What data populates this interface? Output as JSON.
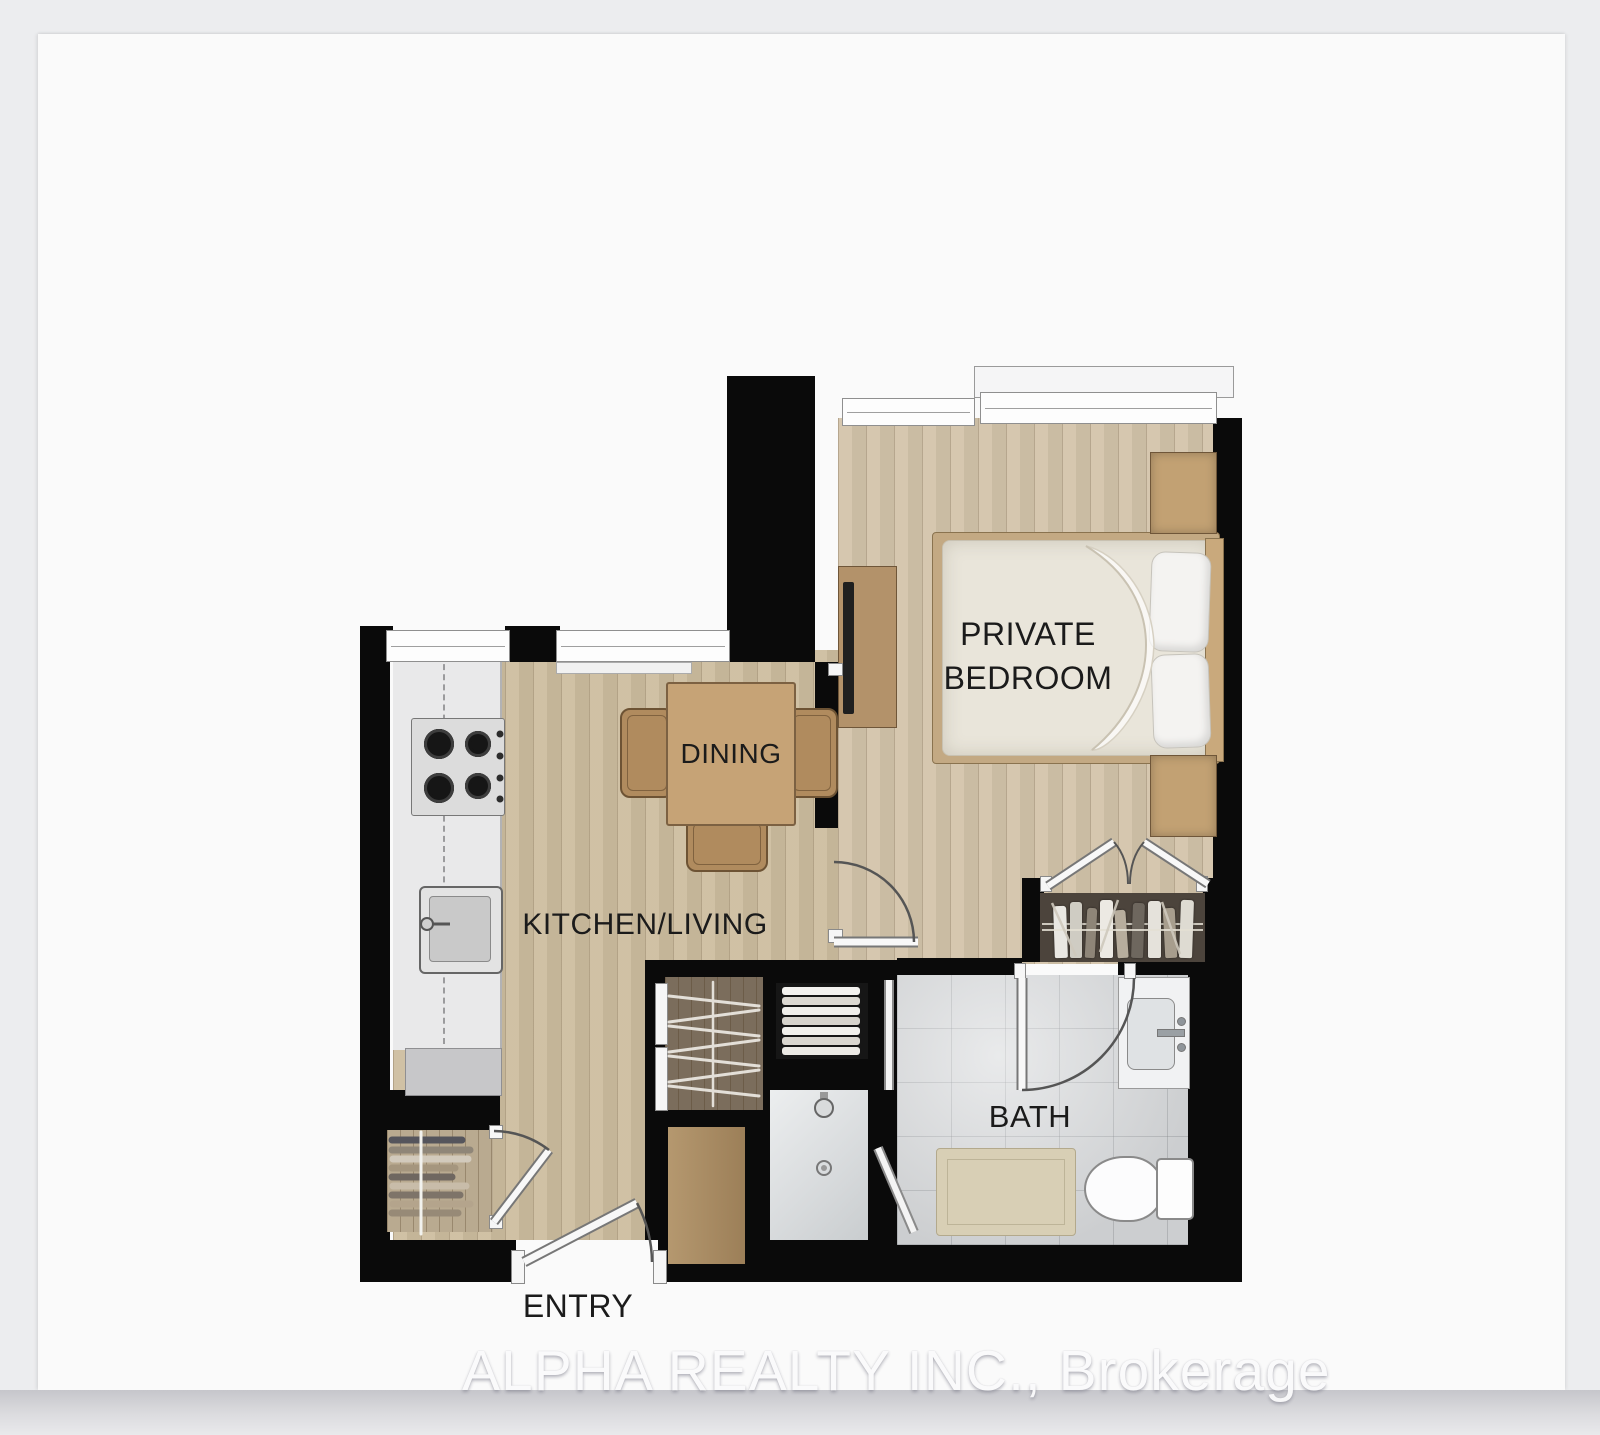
{
  "watermark": {
    "text": "ALPHA REALTY INC., Brokerage"
  },
  "rooms": {
    "bedroom": {
      "label": "PRIVATE BEDROOM"
    },
    "dining": {
      "label": "DINING"
    },
    "kitchen_living": {
      "label": "KITCHEN/LIVING"
    },
    "bath": {
      "label": "BATH"
    },
    "entry": {
      "label": "ENTRY"
    }
  },
  "icons": [
    "bed-icon",
    "pillow-icon",
    "nightstand-icon",
    "tv-console-icon",
    "dining-table-icon",
    "chair-icon",
    "stove-icon",
    "kitchen-sink-icon",
    "bathroom-sink-icon",
    "toilet-icon",
    "bath-mat-icon",
    "shower-icon",
    "towel-stack-icon",
    "bookshelf-icon",
    "hanging-clothes-icon",
    "door-swing-icon",
    "window-icon"
  ],
  "colors": {
    "page_background": "#ecedef",
    "card": "#fafafa",
    "wall": "#0a0a0a",
    "living_floor_wood": "#cdbd9f",
    "bedroom_floor_wood": "#d3c4aa",
    "furniture_wood": "#b9956b",
    "bath_tile": "#d7d9db",
    "bed_linen": "#e9e5da",
    "label_text": "#1b1b1b",
    "watermark_text": "#fbfbfc"
  }
}
